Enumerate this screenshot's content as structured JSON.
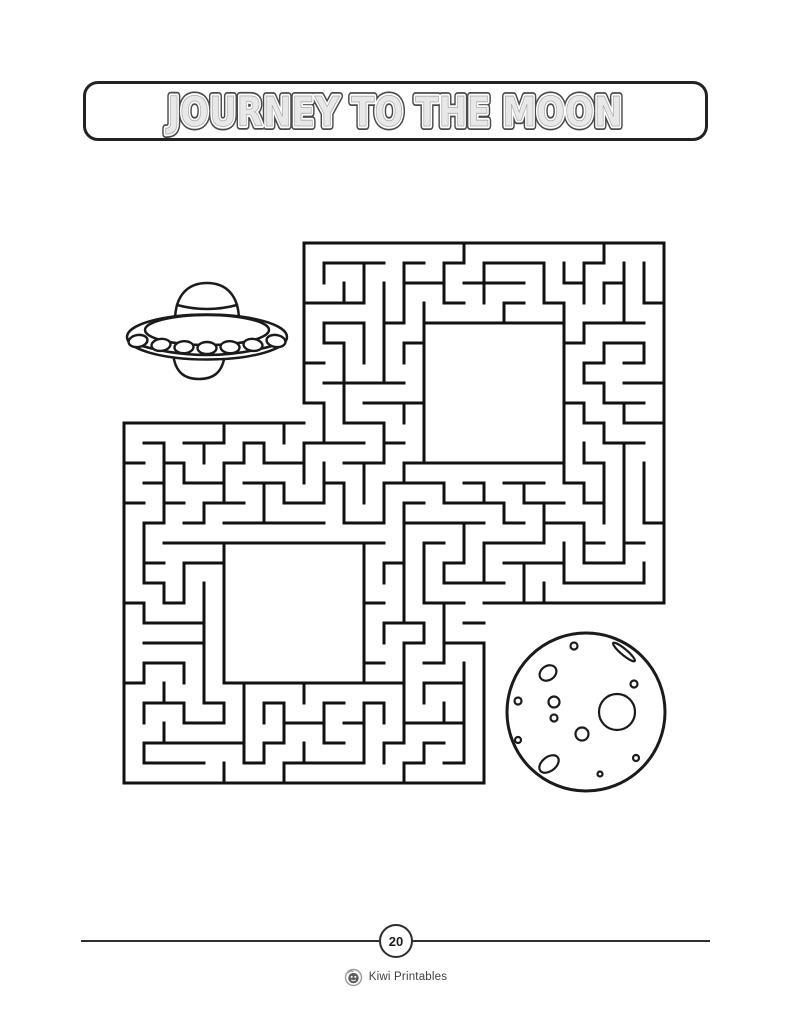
{
  "page": {
    "width": 791,
    "height": 1024,
    "background": "#ffffff",
    "ink": "#1b1b1b"
  },
  "title": {
    "text": "JOURNEY TO THE MOON",
    "body_color": "#e8e8e8",
    "inner_ring_color": "#ffffff",
    "outline_color": "#4a4a4a",
    "edge_color": "#a8a8a8",
    "box_border_color": "#222222"
  },
  "maze": {
    "origin_x": 124,
    "origin_y": 243,
    "cell": 20,
    "cols": 27,
    "rows": 27,
    "wall_color": "#111111",
    "wall_width": 3,
    "square_a": {
      "c0": 9,
      "c1": 26,
      "r0": 0,
      "r1": 17
    },
    "square_b": {
      "c0": 0,
      "c1": 17,
      "r0": 9,
      "r1": 26
    },
    "hole_a": {
      "c0": 15,
      "c1": 21,
      "r0": 4,
      "r1": 10
    },
    "hole_b": {
      "c0": 5,
      "c1": 11,
      "r0": 15,
      "r1": 21
    },
    "openings": [
      {
        "c": 9,
        "r": 8,
        "side": "W"
      },
      {
        "c": 17,
        "r": 18,
        "side": "E"
      },
      {
        "c": 17,
        "r": 19,
        "side": "E"
      }
    ],
    "seed": 11
  },
  "moon": {
    "cx": 586,
    "cy": 712,
    "r": 79,
    "outline_width": 3,
    "crater_width": 2.2,
    "craters": [
      {
        "cx": 574,
        "cy": 646,
        "rx": 3.5,
        "ry": 3.5,
        "rot": 0
      },
      {
        "cx": 624,
        "cy": 652,
        "rx": 14,
        "ry": 3,
        "rot": 40
      },
      {
        "cx": 548,
        "cy": 673,
        "rx": 9,
        "ry": 7,
        "rot": -35
      },
      {
        "cx": 634,
        "cy": 684,
        "rx": 3.5,
        "ry": 3.5,
        "rot": 0
      },
      {
        "cx": 518,
        "cy": 701,
        "rx": 3.5,
        "ry": 3.5,
        "rot": 0
      },
      {
        "cx": 554,
        "cy": 702,
        "rx": 5.5,
        "ry": 5.5,
        "rot": 0
      },
      {
        "cx": 554,
        "cy": 718,
        "rx": 3.5,
        "ry": 3.5,
        "rot": 0
      },
      {
        "cx": 617,
        "cy": 712,
        "rx": 18,
        "ry": 18,
        "rot": 0
      },
      {
        "cx": 582,
        "cy": 734,
        "rx": 6.5,
        "ry": 6.5,
        "rot": 0
      },
      {
        "cx": 518,
        "cy": 740,
        "rx": 3,
        "ry": 3,
        "rot": 0
      },
      {
        "cx": 549,
        "cy": 764,
        "rx": 11,
        "ry": 7,
        "rot": -38
      },
      {
        "cx": 636,
        "cy": 758,
        "rx": 3,
        "ry": 3,
        "rot": 0
      },
      {
        "cx": 600,
        "cy": 774,
        "rx": 2.5,
        "ry": 2.5,
        "rot": 0
      }
    ]
  },
  "footer": {
    "page_number": "20",
    "brand": "Kiwi Printables"
  }
}
